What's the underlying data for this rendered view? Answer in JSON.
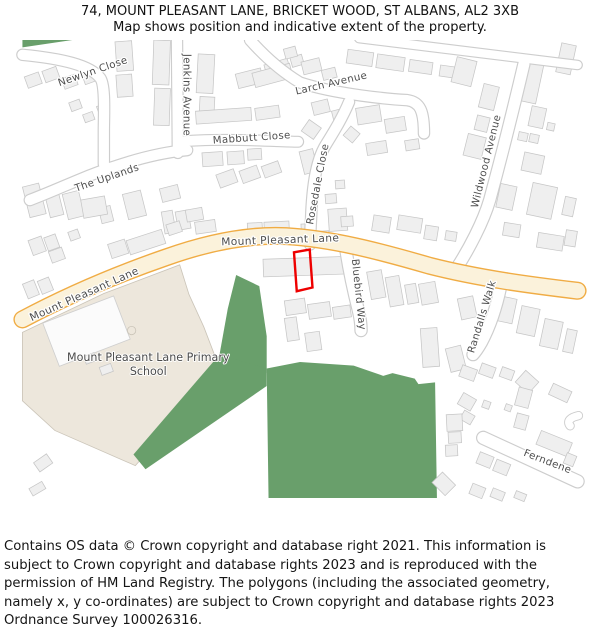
{
  "header": {
    "line1": "74, MOUNT PLEASANT LANE, BRICKET WOOD, ST ALBANS, AL2 3XB",
    "line2": "Map shows position and indicative extent of the property."
  },
  "map": {
    "streets": {
      "newlyn": "Newlyn Close",
      "jenkins": "Jenkins Avenue",
      "larch": "Larch Avenue",
      "mabbutt": "Mabbutt Close",
      "uplands": "The Uplands",
      "rosedale": "Rosedale Close",
      "wildwood": "Wildwood Avenue",
      "mount_pleasant_lane": "Mount Pleasant Lane",
      "bluebird": "Bluebird Way",
      "randalls": "Randalls Walk",
      "ferndene": "Ferndene"
    },
    "school_label_line1": "Mount Pleasant Lane Primary",
    "school_label_line2": "School",
    "colors": {
      "main_road_fill": "#FBF2DB",
      "main_road_casing": "#F0AC44",
      "woodland_green": "#699F6B",
      "school_fill": "#EDE7DC",
      "building_fill": "#EFEFEF",
      "building_stroke": "#C6C6C6",
      "road_casing": "#CDCDCD",
      "road_fill": "#FFFFFF",
      "label_text": "#4D4D4D",
      "property_outline": "#EE0000"
    }
  },
  "footer": {
    "text": "Contains OS data © Crown copyright and database right 2021. This information is subject to Crown copyright and database rights 2023 and is reproduced with the permission of HM Land Registry. The polygons (including the associated geometry, namely x, y co-ordinates) are subject to Crown copyright and database rights 2023 Ordnance Survey 100026316."
  }
}
